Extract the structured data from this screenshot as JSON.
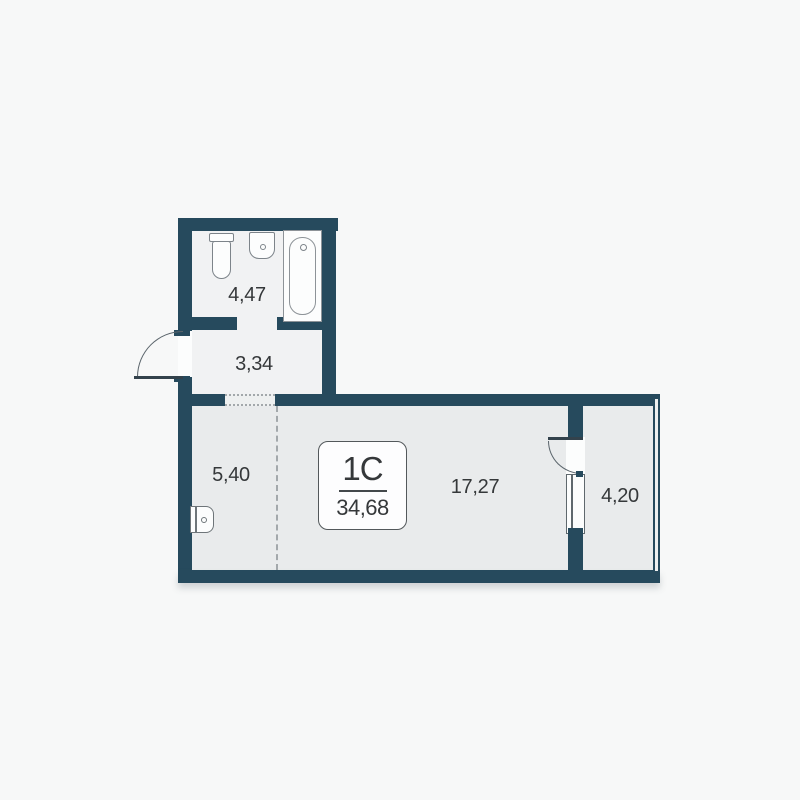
{
  "plan": {
    "badge": {
      "unit_type": "1С",
      "total_area": "34,68"
    },
    "rooms": [
      {
        "name": "bathroom",
        "area": "4,47"
      },
      {
        "name": "hallway",
        "area": "3,34"
      },
      {
        "name": "kitchen-niche",
        "area": "5,40"
      },
      {
        "name": "living-area",
        "area": "17,27"
      },
      {
        "name": "balcony",
        "area": "4,20"
      }
    ],
    "fixtures": [
      "toilet",
      "sink",
      "bathtub",
      "kitchen-sink"
    ],
    "colors": {
      "wall": "#264a5d",
      "floor-light": "#f1f2f3",
      "floor-gray": "#e9ebec",
      "background": "#f7f8f8",
      "fixture-line": "#7d848a",
      "text": "#35383a",
      "dash": "#a3a8ab",
      "door-line": "#33424c",
      "arc-line": "#5a646b",
      "window-line": "#5f686d",
      "white": "#fcfdfd"
    }
  }
}
